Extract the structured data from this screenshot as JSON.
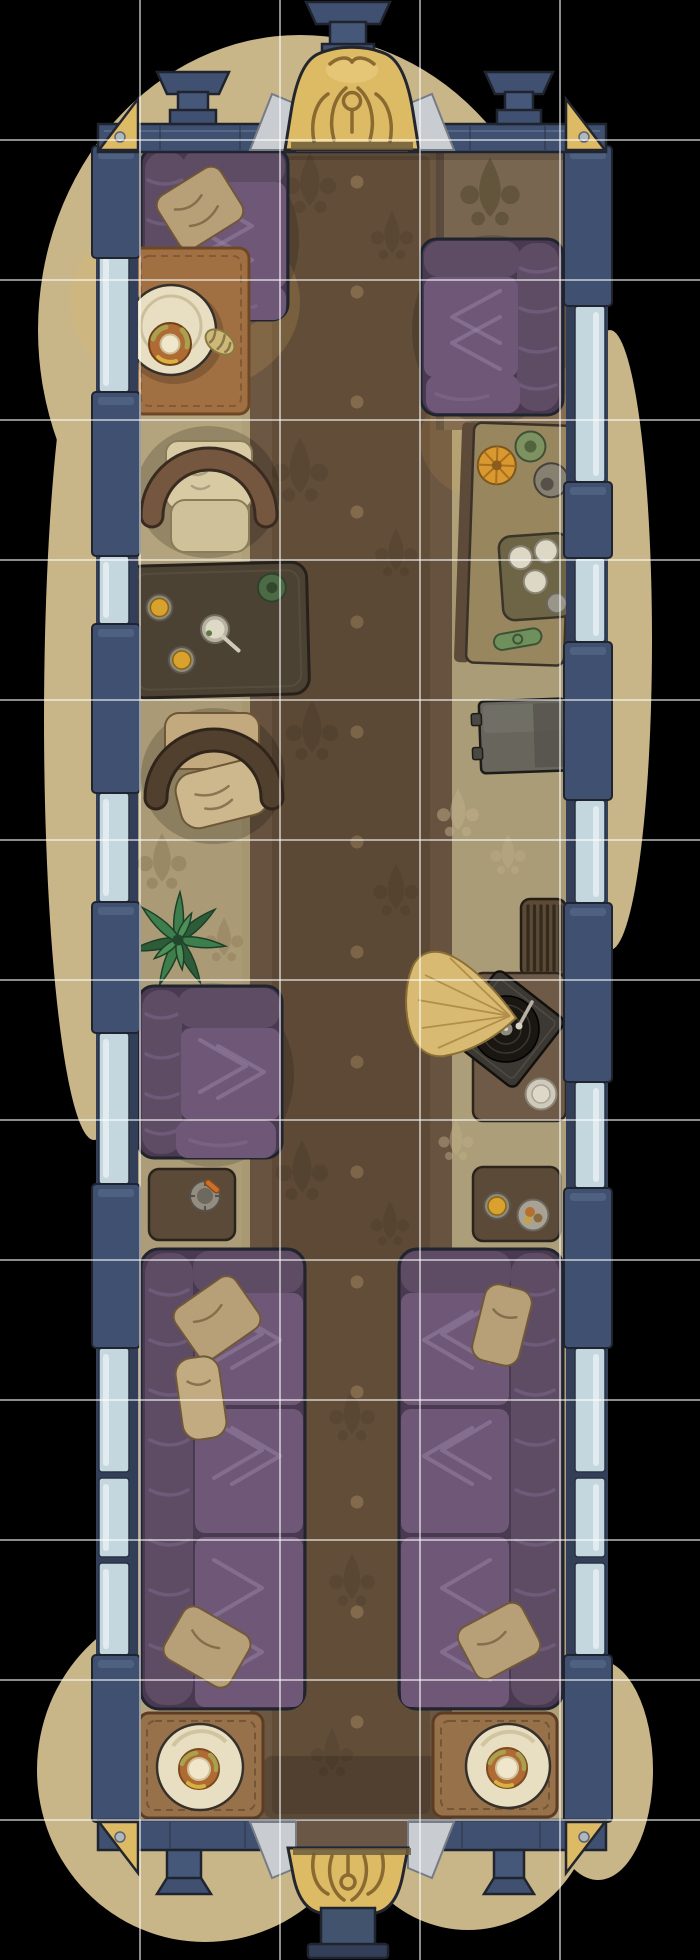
{
  "meta": {
    "title": "Train Parlor Car — hand-painted top-down battle map",
    "view": "top-down",
    "canvas": {
      "width": 700,
      "height": 1960
    }
  },
  "grid": {
    "columns": 5,
    "rows": 14,
    "cell_size_px": 140,
    "line_color": "#ffffff",
    "line_opacity": 0.55,
    "line_width": 2
  },
  "palette": {
    "bg": "#000000",
    "ground": "#c8b689",
    "wall_navy": "#3f5070",
    "wall_navy_dark": "#333f58",
    "window_pale": "#c4d7df",
    "gold": "#ddba64",
    "outline": "#20242e",
    "floor_tan": "#b0a078",
    "olive_zone": "#786650",
    "runner_brown": "#6c5742",
    "runner_dark": "#5e4936",
    "couch_purple": "#5e4b64",
    "couch_purple_dark": "#4a3a51",
    "couch_purple_light": "#6f5877",
    "pillow_tan": "#b7a077",
    "frame_brown": "#75563e",
    "frame_brown_dark": "#52402f",
    "cushion_cream": "#d8cba4",
    "cushion_tan": "#c2aa7e",
    "table_olive": "#4b4234",
    "table_brown": "#6e5a46",
    "table_brown2": "#5c4a38",
    "mat_orange": "#a06f42",
    "mat_brown": "#96714a",
    "plate_cream": "#e8dfc2",
    "donut_orange": "#b06a33",
    "amber": "#d9a12e",
    "plant_green": "#3e7d4c",
    "plant_green_dark": "#2c5c38",
    "horn_tan": "#d9ba72",
    "record_dark": "#1a1713",
    "box_dark": "#3c3833",
    "cabinet_gray": "#67655c",
    "radiator_brown": "#5b4a35",
    "silver": "#c9cdd1",
    "wood": "#6b5745"
  },
  "ground_blobs": [
    {
      "cx": 300,
      "cy": 330,
      "rx": 262,
      "ry": 295
    },
    {
      "cx": 94,
      "cy": 720,
      "rx": 50,
      "ry": 420
    },
    {
      "cx": 610,
      "cy": 640,
      "rx": 42,
      "ry": 310
    },
    {
      "cx": 205,
      "cy": 1770,
      "rx": 168,
      "ry": 172
    },
    {
      "cx": 468,
      "cy": 1792,
      "rx": 128,
      "ry": 138
    },
    {
      "cx": 598,
      "cy": 1770,
      "rx": 55,
      "ry": 110
    }
  ],
  "glows": [
    {
      "cx": 185,
      "cy": 302,
      "rx": 115,
      "ry": 92,
      "color": "#f0b55f",
      "opacity": 0.17
    },
    {
      "cx": 172,
      "cy": 318,
      "rx": 66,
      "ry": 55,
      "color": "#f6c66a",
      "opacity": 0.18
    },
    {
      "cx": 505,
      "cy": 440,
      "rx": 85,
      "ry": 65,
      "color": "#e8b055",
      "opacity": 0.12
    }
  ],
  "walls": {
    "left": {
      "base_x": 96,
      "base_w": 42,
      "glass_x": 99,
      "glass_w": 30,
      "post_x": 92,
      "post_w": 48,
      "posts": [
        [
          146,
          258
        ],
        [
          392,
          556
        ],
        [
          624,
          793
        ],
        [
          902,
          1033
        ],
        [
          1184,
          1348
        ],
        [
          1655,
          1822
        ]
      ],
      "windows": [
        [
          252,
          392
        ],
        [
          556,
          624
        ],
        [
          793,
          902
        ],
        [
          1033,
          1184
        ],
        [
          1348,
          1472
        ],
        [
          1478,
          1557
        ],
        [
          1563,
          1655
        ]
      ]
    },
    "right": {
      "base_x": 566,
      "base_w": 42,
      "glass_x": 575,
      "glass_w": 30,
      "post_x": 564,
      "post_w": 48,
      "posts": [
        [
          146,
          306
        ],
        [
          482,
          558
        ],
        [
          642,
          800
        ],
        [
          903,
          1082
        ],
        [
          1188,
          1348
        ],
        [
          1655,
          1822
        ]
      ],
      "windows": [
        [
          306,
          482
        ],
        [
          558,
          642
        ],
        [
          800,
          903
        ],
        [
          1082,
          1188
        ],
        [
          1348,
          1472
        ],
        [
          1478,
          1557
        ],
        [
          1563,
          1655
        ]
      ]
    }
  },
  "runner_dots": {
    "x": 357,
    "y_start": 182,
    "y_end": 1795,
    "step": 110,
    "radius": 6.5,
    "color": "#8f7453",
    "opacity": 0.75
  },
  "objects": [
    {
      "id": "vestibule-top",
      "label": "Top vestibule: ornate gold canopy, roof chimneys, brass corner brackets",
      "px": [
        98,
        0,
        508,
        152
      ]
    },
    {
      "id": "sofa-top-left",
      "label": "Purple two-seat sofa with tan pillow",
      "px": [
        141,
        147,
        147,
        174
      ]
    },
    {
      "id": "side-table-top-left",
      "label": "Round table with pastry plate and croissant on orange mat (lamplit)",
      "px": [
        133,
        247,
        116,
        167
      ]
    },
    {
      "id": "sofa-top-right",
      "label": "Purple loveseat facing left",
      "px": [
        421,
        238,
        142,
        177
      ]
    },
    {
      "id": "desk-right",
      "label": "Sideboard desk: potted plant, orange parasol, tape reel, cup tray, green dish",
      "px": [
        458,
        424,
        110,
        240
      ]
    },
    {
      "id": "armchair-upper",
      "label": "Cream armchair with wooden frame",
      "px": [
        140,
        423,
        137,
        132
      ]
    },
    {
      "id": "coffee-table-left",
      "label": "Dark coffee table: two amber drinks, teacup with spoon, green coaster",
      "px": [
        127,
        563,
        181,
        134
      ]
    },
    {
      "id": "armchair-lower",
      "label": "Tan armchair with throw pillow",
      "px": [
        147,
        705,
        133,
        132
      ]
    },
    {
      "id": "potted-plant",
      "label": "Leafy green plant",
      "px": [
        138,
        896,
        80,
        90
      ]
    },
    {
      "id": "sofa-left-middle",
      "label": "Purple loveseat facing right",
      "px": [
        137,
        985,
        145,
        175
      ]
    },
    {
      "id": "side-table-ashtray",
      "label": "Small table with ashtray and cigar",
      "px": [
        148,
        1168,
        87,
        73
      ]
    },
    {
      "id": "cabinet-right",
      "label": "Gray cabinet / safe",
      "px": [
        478,
        698,
        88,
        75
      ]
    },
    {
      "id": "radiator-right",
      "label": "Ribbed radiator",
      "px": [
        520,
        898,
        47,
        80
      ]
    },
    {
      "id": "gramophone-table",
      "label": "Gramophone with brass horn fan, vinyl record and saucer",
      "px": [
        472,
        970,
        95,
        152
      ]
    },
    {
      "id": "side-table-right",
      "label": "Small table with amber drink and snack plate",
      "px": [
        472,
        1166,
        89,
        76
      ]
    },
    {
      "id": "sofa-bottom-left",
      "label": "Long purple sofa, three cushions, three tan pillows",
      "px": [
        140,
        1248,
        166,
        462
      ]
    },
    {
      "id": "sofa-bottom-right",
      "label": "Long purple sofa, three cushions, two tan pillows",
      "px": [
        398,
        1248,
        166,
        462
      ]
    },
    {
      "id": "dining-table-bottom-left",
      "label": "Table mat with bagel plate",
      "px": [
        139,
        1712,
        124,
        106
      ]
    },
    {
      "id": "dining-table-bottom-right",
      "label": "Table mat with bagel plate",
      "px": [
        433,
        1712,
        124,
        105
      ]
    },
    {
      "id": "vestibule-bottom",
      "label": "Bottom vestibule: gold canopy, coupler pedestal, corner brackets",
      "px": [
        98,
        1820,
        508,
        140
      ]
    }
  ]
}
